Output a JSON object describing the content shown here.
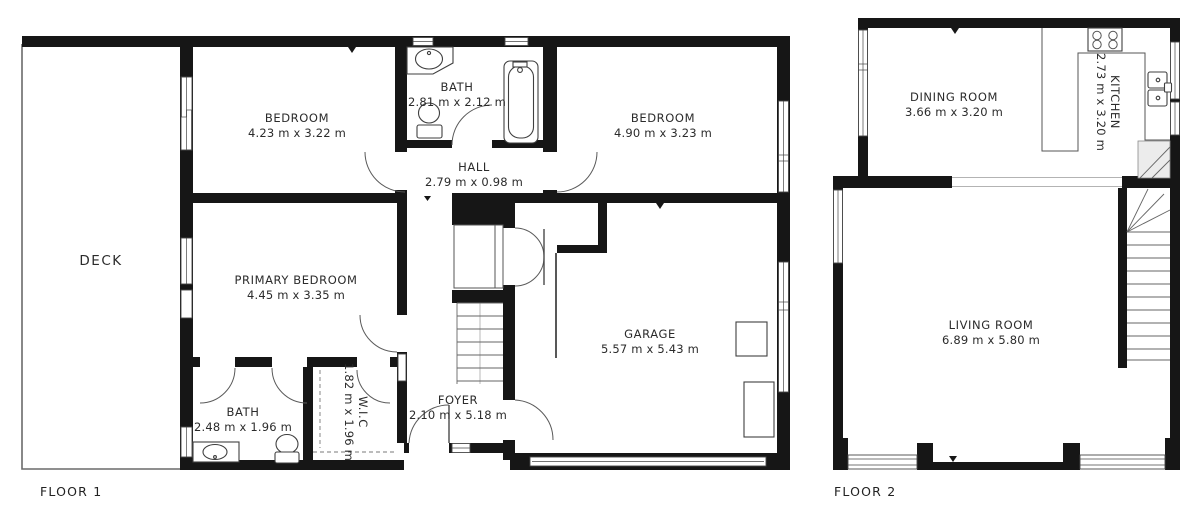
{
  "colors": {
    "wall": "#161616",
    "line": "#555555",
    "text": "#2b2b2b",
    "bg": "#ffffff"
  },
  "floor1": {
    "label": "FLOOR 1",
    "rooms": {
      "deck": {
        "name": "DECK"
      },
      "bedroom1": {
        "name": "BEDROOM",
        "dims": "4.23 m x 3.22 m"
      },
      "bath1": {
        "name": "BATH",
        "dims": "2.81 m x 2.12 m"
      },
      "bedroom2": {
        "name": "BEDROOM",
        "dims": "4.90 m x 3.23 m"
      },
      "hall": {
        "name": "HALL",
        "dims": "2.79 m x 0.98 m"
      },
      "primary": {
        "name": "PRIMARY BEDROOM",
        "dims": "4.45 m x 3.35 m"
      },
      "garage": {
        "name": "GARAGE",
        "dims": "5.57 m x 5.43 m"
      },
      "bath2": {
        "name": "BATH",
        "dims": "2.48 m x 1.96 m"
      },
      "wic": {
        "name": "W.I.C",
        "dims": "1.82 m x 1.96 m"
      },
      "foyer": {
        "name": "FOYER",
        "dims": "2.10 m x 5.18 m"
      }
    }
  },
  "floor2": {
    "label": "FLOOR 2",
    "rooms": {
      "dining": {
        "name": "DINING ROOM",
        "dims": "3.66 m x 3.20 m"
      },
      "kitchen": {
        "name": "KITCHEN",
        "dims": "2.73 m x 3.20 m"
      },
      "living": {
        "name": "LIVING ROOM",
        "dims": "6.89 m x 5.80 m"
      }
    }
  }
}
